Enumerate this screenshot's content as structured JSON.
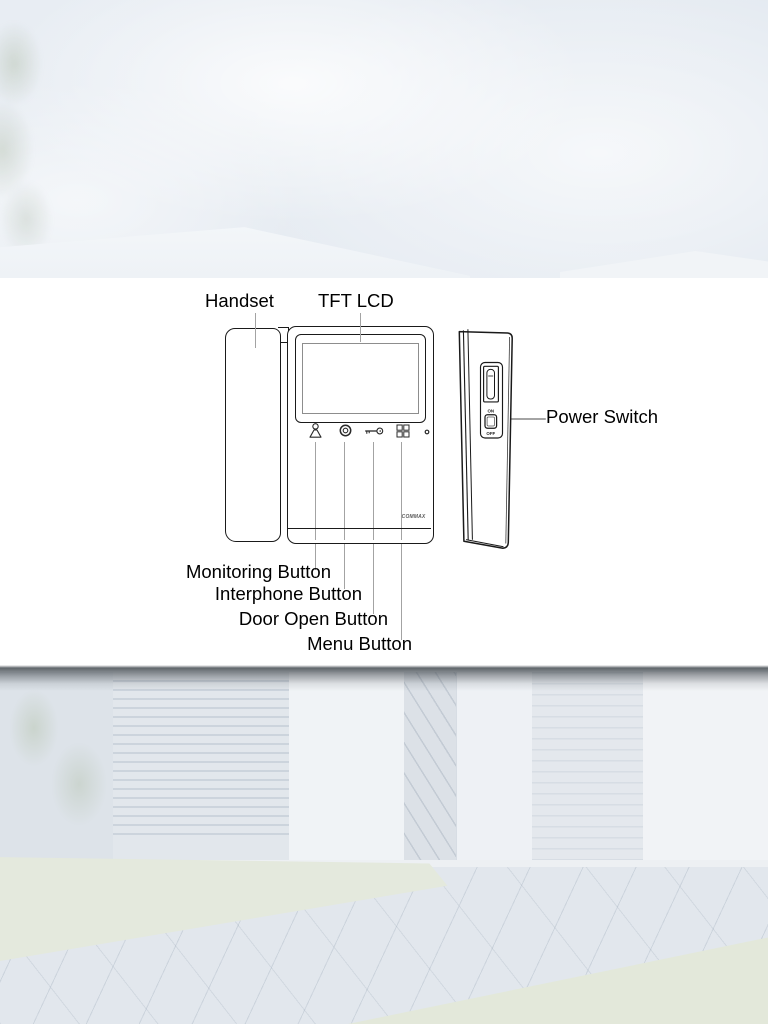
{
  "labels": {
    "handset": "Handset",
    "tft_lcd": "TFT LCD",
    "power_switch": "Power Switch",
    "monitoring_button": "Monitoring Button",
    "interphone_button": "Interphone Button",
    "door_open_button": "Door Open Button",
    "menu_button": "Menu Button"
  },
  "device": {
    "brand_logo": "COMMAX",
    "power_switch": {
      "on_label": "ON",
      "off_label": "OFF"
    },
    "front_icons": [
      "monitoring-icon",
      "interphone-icon",
      "door-open-key-icon",
      "menu-grid-icon",
      "led-indicator-dot"
    ],
    "side_features": [
      "card-slot",
      "power-switch"
    ]
  },
  "colors": {
    "panel_background": "#ffffff",
    "outline": "#1a1a1a",
    "leader_line": "#a3a3a3",
    "sky_tint": "#e8edf3",
    "photo_tint": "#e9edf0",
    "divider_shadow": "#4a5056"
  }
}
